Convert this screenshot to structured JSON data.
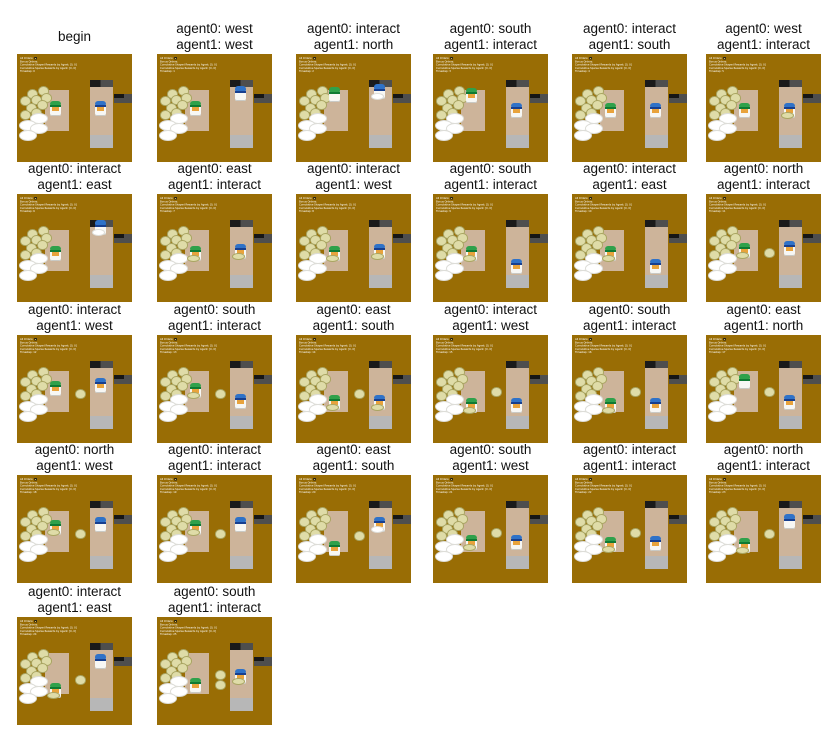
{
  "title": "two-agent overcooked trajectory grid",
  "hud": {
    "all_orders_label": "All Orders:",
    "all_orders_icon": "soup-order-icon",
    "bonus_orders_label": "Bonus Orders:",
    "shaped_rewards_label": "Cumulative Shaped Rewards by Agent: [0, 0]",
    "sparse_rewards_label": "Cumulative Sparse Rewards by Agent: [0, 0]",
    "timestep_label": "Timestep:"
  },
  "colors": {
    "floor_bg": "#996D05",
    "corridor": "#CDB49A",
    "serving": "#B7B7B7",
    "pot_dark": "#1A1A1A",
    "pot_gray": "#4E4E4E",
    "onion_fill": "#DFDCA8",
    "onion_edge": "#A9A562",
    "plate_fill": "#FFFFFF",
    "plate_edge": "#DDDDD8",
    "agent0_hat": "#2FA14B",
    "agent0_band": "#0F7A33",
    "agent1_hat": "#2F72C8",
    "agent1_band": "#173F8F",
    "skin": "#E8A33C",
    "body": "#F7F7F4",
    "hud_text": "#FFFFFF",
    "caption_text": "#111111"
  },
  "layout": {
    "cols_x": [
      17,
      157,
      296,
      433,
      572,
      706
    ],
    "rows_frame_y": [
      57,
      197,
      338,
      478,
      620
    ],
    "onion_pile": [
      [
        9,
        32
      ],
      [
        18,
        30
      ],
      [
        3,
        39
      ],
      [
        12,
        38
      ],
      [
        21,
        36
      ],
      [
        8,
        45
      ],
      [
        17,
        43
      ],
      [
        3,
        52
      ],
      [
        12,
        50
      ]
    ],
    "plate_pile": [
      [
        11,
        55
      ],
      [
        2,
        61
      ],
      [
        11,
        64
      ],
      [
        2,
        70
      ]
    ]
  },
  "frames": [
    {
      "caption": [
        "begin"
      ],
      "timestep": 0,
      "a0": {
        "y": 50,
        "dir": "S",
        "hold": null
      },
      "a1": {
        "y": 50,
        "dir": "S",
        "hold": null
      },
      "mid": []
    },
    {
      "caption": [
        "agent0: west",
        "agent1: west"
      ],
      "timestep": 1,
      "a0": {
        "y": 50,
        "dir": "S",
        "hold": null
      },
      "a1": {
        "y": 36,
        "dir": "N",
        "hold": null
      },
      "mid": []
    },
    {
      "caption": [
        "agent0: interact",
        "agent1: north"
      ],
      "timestep": 2,
      "a0": {
        "y": 37,
        "dir": "N",
        "hold": null
      },
      "a1": {
        "y": 34,
        "dir": "N",
        "hold": "plate"
      },
      "mid": []
    },
    {
      "caption": [
        "agent0: south",
        "agent1: interact"
      ],
      "timestep": 3,
      "a0": {
        "y": 38,
        "dir": "S",
        "hold": null
      },
      "a1": {
        "y": 52,
        "dir": "S",
        "hold": null
      },
      "mid": []
    },
    {
      "caption": [
        "agent0: interact",
        "agent1: south"
      ],
      "timestep": 4,
      "a0": {
        "y": 52,
        "dir": "S",
        "hold": null
      },
      "a1": {
        "y": 52,
        "dir": "S",
        "hold": null
      },
      "mid": []
    },
    {
      "caption": [
        "agent0: west",
        "agent1: interact"
      ],
      "timestep": 5,
      "a0": {
        "y": 52,
        "dir": "S",
        "hold": null
      },
      "a1": {
        "y": 52,
        "dir": "S",
        "hold": "onion"
      },
      "mid": []
    },
    {
      "caption": [
        "agent0: interact",
        "agent1: east"
      ],
      "timestep": 6,
      "a0": {
        "y": 55,
        "dir": "S",
        "hold": null
      },
      "a1": {
        "y": 31,
        "dir": "N",
        "hold": "plate"
      },
      "mid": []
    },
    {
      "caption": [
        "agent0: east",
        "agent1: interact"
      ],
      "timestep": 7,
      "a0": {
        "y": 55,
        "dir": "S",
        "hold": "onion"
      },
      "a1": {
        "y": 53,
        "dir": "S",
        "hold": "onion"
      },
      "mid": []
    },
    {
      "caption": [
        "agent0: interact",
        "agent1: west"
      ],
      "timestep": 8,
      "a0": {
        "y": 55,
        "dir": "S",
        "hold": "onion"
      },
      "a1": {
        "y": 53,
        "dir": "S",
        "hold": "onion"
      },
      "mid": []
    },
    {
      "caption": [
        "agent0: south",
        "agent1: interact"
      ],
      "timestep": 9,
      "a0": {
        "y": 55,
        "dir": "S",
        "hold": "onion"
      },
      "a1": {
        "y": 67,
        "dir": "S",
        "hold": null
      },
      "mid": []
    },
    {
      "caption": [
        "agent0: interact",
        "agent1: east"
      ],
      "timestep": 10,
      "a0": {
        "y": 55,
        "dir": "S",
        "hold": "onion"
      },
      "a1": {
        "y": 67,
        "dir": "S",
        "hold": null
      },
      "mid": []
    },
    {
      "caption": [
        "agent0: north",
        "agent1: interact"
      ],
      "timestep": 11,
      "a0": {
        "y": 52,
        "dir": "S",
        "hold": "onion"
      },
      "a1": {
        "y": 50,
        "dir": "W",
        "hold": null
      },
      "mid": [
        [
          50,
          50
        ]
      ]
    },
    {
      "caption": [
        "agent0: interact",
        "agent1: west"
      ],
      "timestep": 12,
      "a0": {
        "y": 49,
        "dir": "S",
        "hold": null
      },
      "a1": {
        "y": 46,
        "dir": "W",
        "hold": null
      },
      "mid": [
        [
          50,
          50
        ]
      ]
    },
    {
      "caption": [
        "agent0: south",
        "agent1: interact"
      ],
      "timestep": 13,
      "a0": {
        "y": 51,
        "dir": "S",
        "hold": "onion"
      },
      "a1": {
        "y": 61,
        "dir": "S",
        "hold": null
      },
      "mid": [
        [
          50,
          50
        ]
      ]
    },
    {
      "caption": [
        "agent0: east",
        "agent1: south"
      ],
      "timestep": 14,
      "a0": {
        "y": 62,
        "dir": "E",
        "hold": "onion"
      },
      "a1": {
        "y": 62,
        "dir": "S",
        "hold": "onion"
      },
      "mid": [
        [
          50,
          50
        ]
      ]
    },
    {
      "caption": [
        "agent0: interact",
        "agent1: west"
      ],
      "timestep": 15,
      "a0": {
        "y": 65,
        "dir": "S",
        "hold": "onion"
      },
      "a1": {
        "y": 65,
        "dir": "W",
        "hold": null
      },
      "mid": [
        [
          50,
          48
        ]
      ]
    },
    {
      "caption": [
        "agent0: south",
        "agent1: interact"
      ],
      "timestep": 16,
      "a0": {
        "y": 65,
        "dir": "S",
        "hold": "onion"
      },
      "a1": {
        "y": 65,
        "dir": "S",
        "hold": null
      },
      "mid": [
        [
          50,
          48
        ]
      ]
    },
    {
      "caption": [
        "agent0: east",
        "agent1: north"
      ],
      "timestep": 17,
      "a0": {
        "y": 43,
        "dir": "N",
        "hold": null
      },
      "a1": {
        "y": 62,
        "dir": "S",
        "hold": null
      },
      "mid": [
        [
          50,
          48
        ]
      ]
    },
    {
      "caption": [
        "agent0: north",
        "agent1: west"
      ],
      "timestep": 18,
      "a0": {
        "y": 48,
        "dir": "S",
        "hold": "onion"
      },
      "a1": {
        "y": 45,
        "dir": "N",
        "hold": null
      },
      "mid": [
        [
          50,
          50
        ]
      ]
    },
    {
      "caption": [
        "agent0: interact",
        "agent1: interact"
      ],
      "timestep": 19,
      "a0": {
        "y": 48,
        "dir": "S",
        "hold": "onion"
      },
      "a1": {
        "y": 45,
        "dir": "N",
        "hold": null
      },
      "mid": [
        [
          50,
          50
        ]
      ]
    },
    {
      "caption": [
        "agent0: east",
        "agent1: south"
      ],
      "timestep": 20,
      "a0": {
        "y": 68,
        "dir": "S",
        "hold": null
      },
      "a1": {
        "y": 45,
        "dir": "S",
        "hold": "plate"
      },
      "mid": [
        [
          50,
          52
        ]
      ]
    },
    {
      "caption": [
        "agent0: south",
        "agent1: west"
      ],
      "timestep": 21,
      "a0": {
        "y": 62,
        "dir": "S",
        "hold": "onion"
      },
      "a1": {
        "y": 62,
        "dir": "W",
        "hold": null
      },
      "mid": [
        [
          50,
          49
        ]
      ]
    },
    {
      "caption": [
        "agent0: interact",
        "agent1: interact"
      ],
      "timestep": 22,
      "a0": {
        "y": 64,
        "dir": "S",
        "hold": "onion"
      },
      "a1": {
        "y": 63,
        "dir": "S",
        "hold": null
      },
      "mid": [
        [
          50,
          49
        ]
      ]
    },
    {
      "caption": [
        "agent0: north",
        "agent1: interact"
      ],
      "timestep": 23,
      "a0": {
        "y": 65,
        "dir": "S",
        "hold": "onion"
      },
      "a1": {
        "y": 43,
        "dir": "N",
        "hold": null
      },
      "mid": [
        [
          50,
          50
        ]
      ]
    },
    {
      "caption": [
        "agent0: interact",
        "agent1: east"
      ],
      "timestep": 24,
      "a0": {
        "y": 68,
        "dir": "S",
        "hold": "onion"
      },
      "a1": {
        "y": 41,
        "dir": "N",
        "hold": null
      },
      "mid": [
        [
          50,
          54
        ]
      ]
    },
    {
      "caption": [
        "agent0: south",
        "agent1: interact"
      ],
      "timestep": 25,
      "a0": {
        "y": 63,
        "dir": "S",
        "hold": null
      },
      "a1": {
        "y": 55,
        "dir": "S",
        "hold": "onion"
      },
      "mid": [
        [
          50,
          49
        ],
        [
          50,
          58
        ]
      ]
    }
  ]
}
